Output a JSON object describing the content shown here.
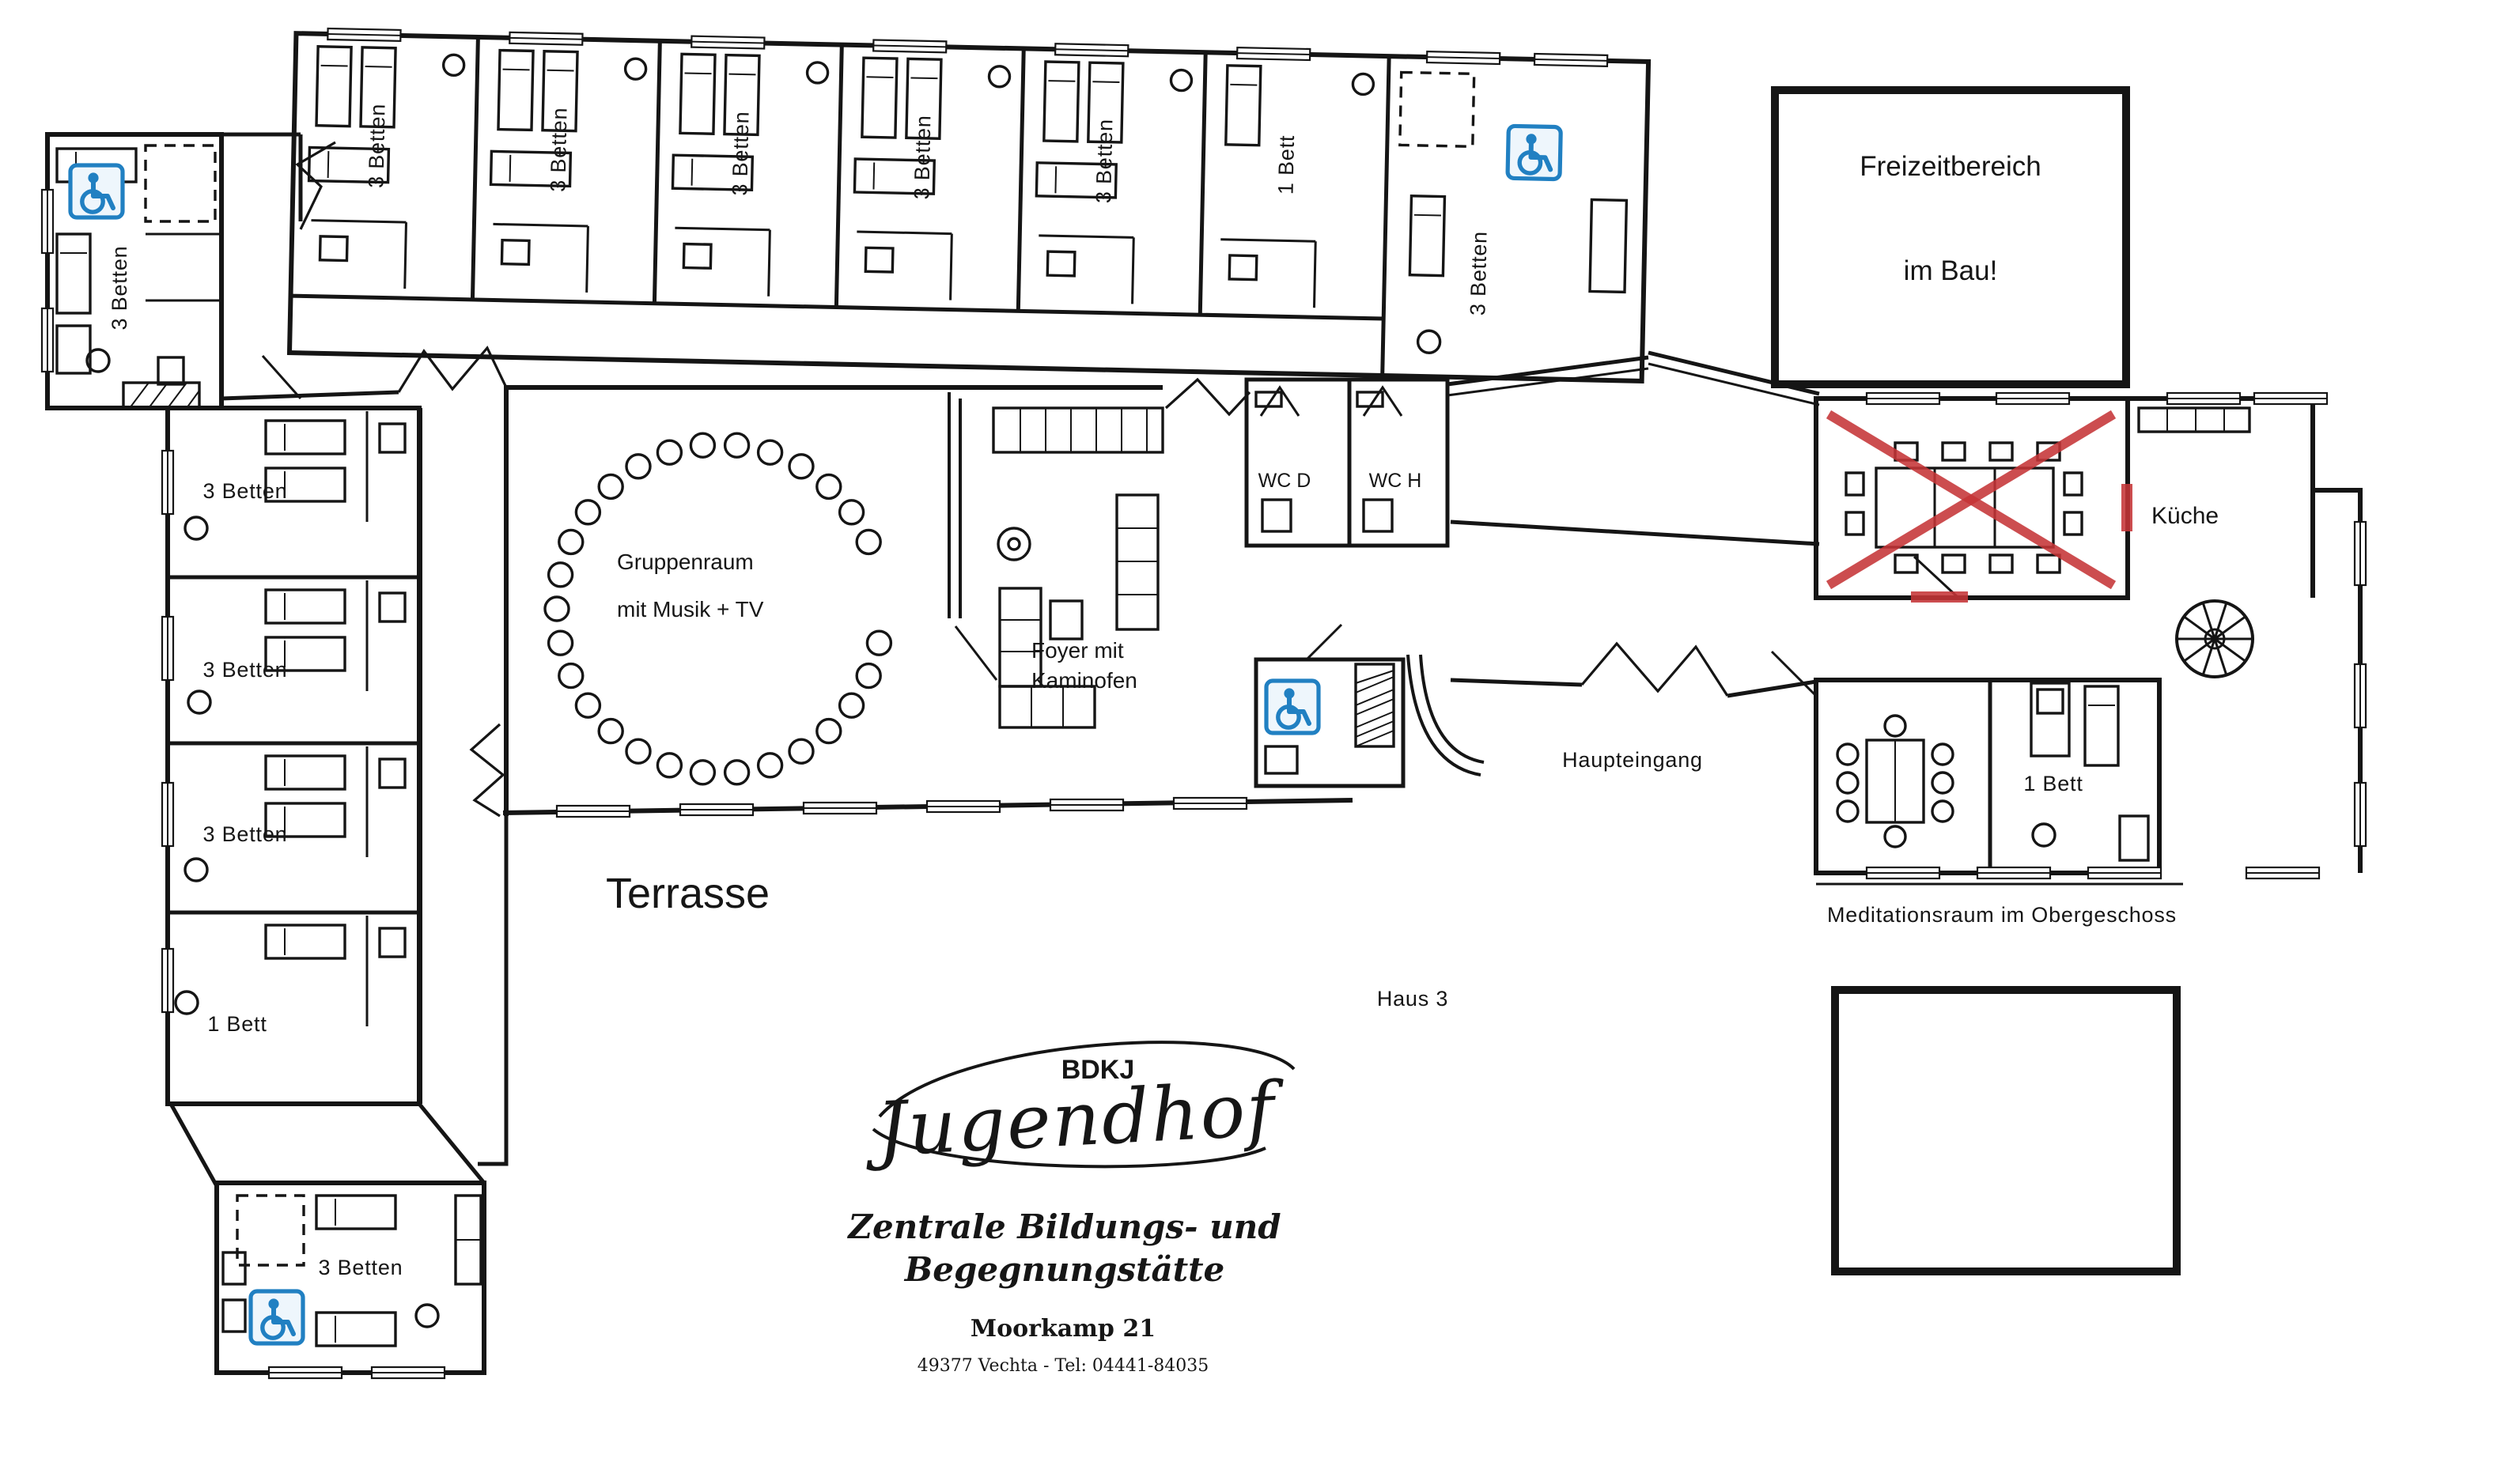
{
  "colors": {
    "wall": "#151515",
    "red": "#c53437",
    "blue": "#2180c2",
    "blue_light": "#eef6fc",
    "paper": "#ffffff"
  },
  "icons": {
    "wheelchair": "♿"
  },
  "labels": {
    "terrasse": "Terrasse",
    "haus3": "Haus 3",
    "haupteingang": "Haupteingang",
    "meditationsraum_note": "Meditationsraum im Obergeschoss",
    "freizeit1": "Freizeitbereich",
    "freizeit2": "im Bau!",
    "gruppenraum1": "Gruppenraum",
    "gruppenraum2": "mit Musik + TV",
    "foyer1": "Foyer mit",
    "foyer2": "Kaminofen",
    "wc_d": "WC D",
    "wc_h": "WC H",
    "kueche": "Küche"
  },
  "rooms": {
    "top_left": {
      "label": "3 Betten",
      "accessible": true
    },
    "top_row": [
      {
        "label": "3 Betten"
      },
      {
        "label": "3 Betten"
      },
      {
        "label": "3 Betten"
      },
      {
        "label": "3 Betten"
      },
      {
        "label": "3 Betten"
      },
      {
        "label": "1 Bett"
      }
    ],
    "top_right": {
      "label": "3 Betten",
      "accessible": true
    },
    "left_column": [
      {
        "label": "3 Betten"
      },
      {
        "label": "3 Betten"
      },
      {
        "label": "3 Betten"
      },
      {
        "label": "1 Bett"
      }
    ],
    "bottom_left": {
      "label": "3 Betten",
      "accessible": true
    },
    "meditation_wing_bedroom": {
      "label": "1 Bett"
    }
  },
  "logo": {
    "org": "BDKJ",
    "name_script": "Jugendhof",
    "line1": "Zentrale Bildungs- und",
    "line2": "Begegnungstätte",
    "street": "Moorkamp 21",
    "city_tel": "49377 Vechta  -  Tel: 04441-84035"
  }
}
